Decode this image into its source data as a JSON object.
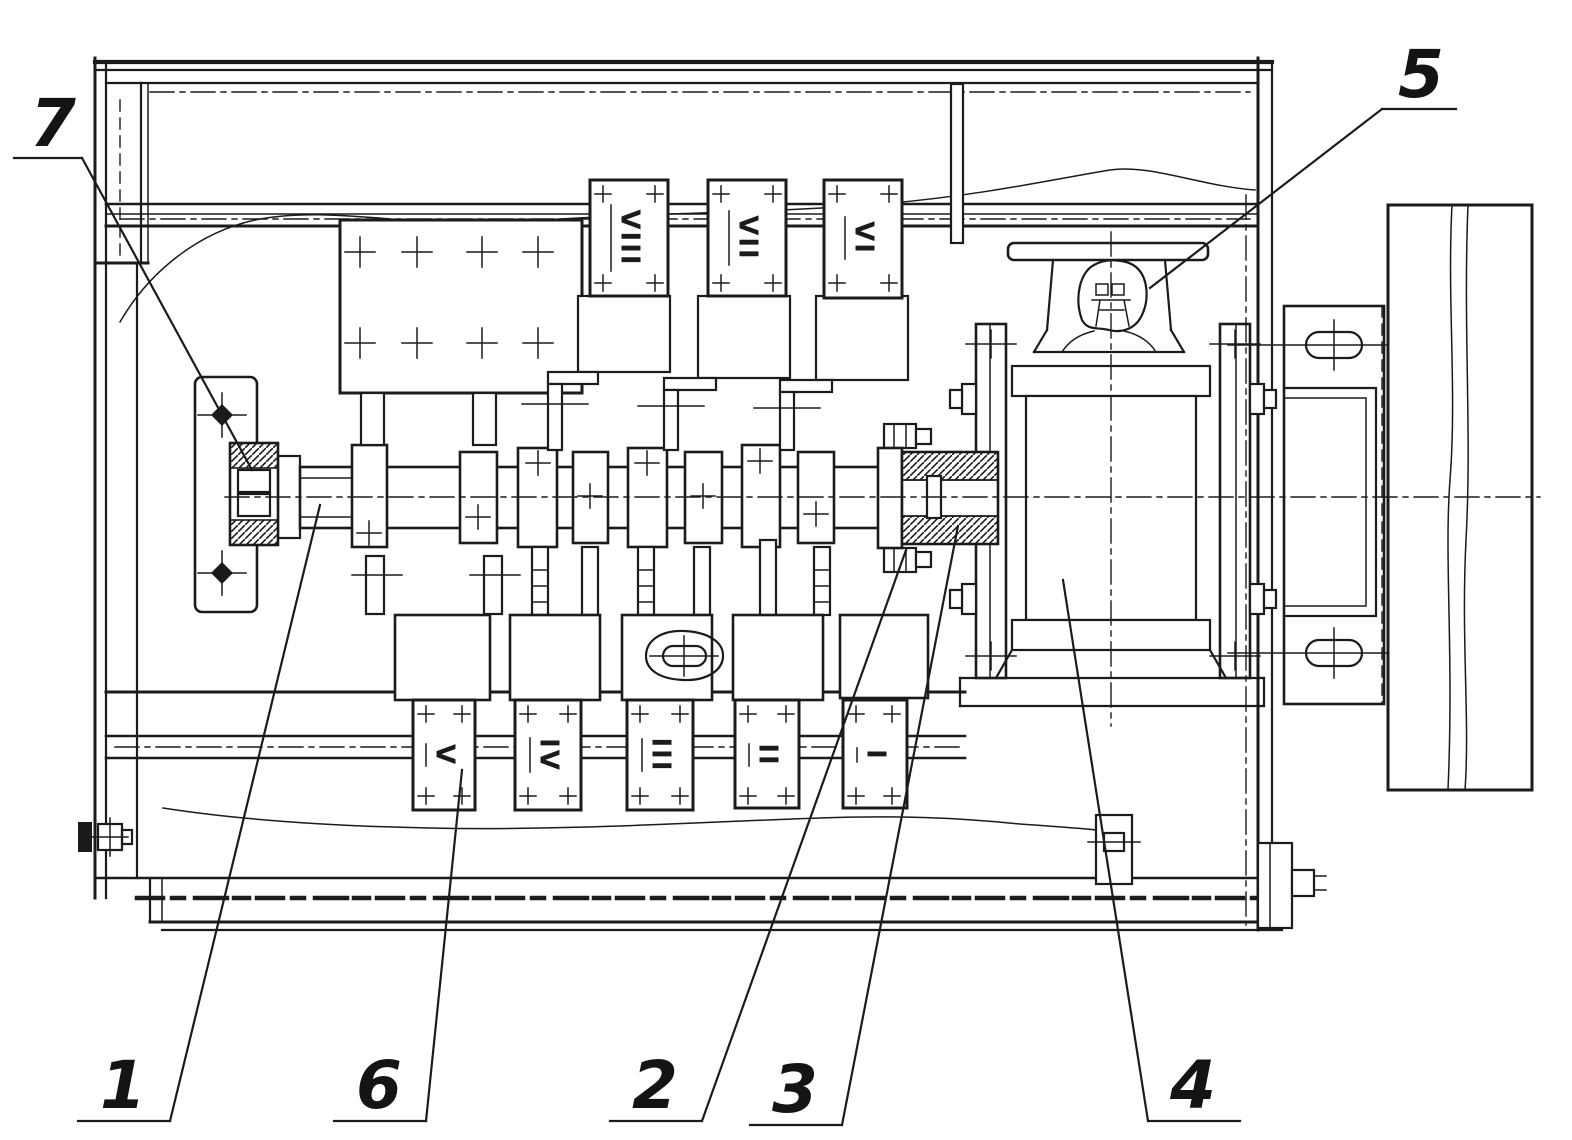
{
  "figure": {
    "type": "technical-assembly-drawing",
    "ink_color": "#1b1b1b",
    "paper_color": "#ffffff"
  },
  "callouts": [
    {
      "num": "1"
    },
    {
      "num": "2"
    },
    {
      "num": "3"
    },
    {
      "num": "4"
    },
    {
      "num": "5"
    },
    {
      "num": "6"
    },
    {
      "num": "7"
    }
  ],
  "stations": {
    "upper": [
      {
        "label": "VIII"
      },
      {
        "label": "VII"
      },
      {
        "label": "VI"
      }
    ],
    "lower": [
      {
        "label": "V"
      },
      {
        "label": "IV"
      },
      {
        "label": "III"
      },
      {
        "label": "II"
      },
      {
        "label": "I"
      }
    ]
  }
}
